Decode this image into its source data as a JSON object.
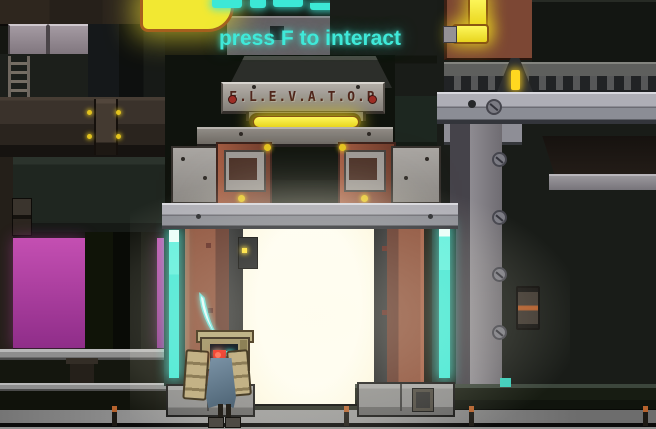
{
  "hud": {
    "interaction_prompt": "press F to interact"
  },
  "elevator": {
    "sign_text": "E.L.E.V.A.T.O.R"
  },
  "sprites": {
    "player": "player-character",
    "weapon": "energy-blade-icon",
    "companion": "crate-robot-backpack"
  },
  "colors": {
    "prompt_cyan": "#3fe9d9",
    "neon_yellow": "#f2e832",
    "cyan_strip": "#3fe8d5",
    "magenta_top": "#c44fb2",
    "magenta_bottom": "#8f2d89",
    "door_white": "#fffef4",
    "rust": "#8a4c36",
    "steel": "#9da0a8",
    "floor_gray": "#8f8f8f"
  }
}
